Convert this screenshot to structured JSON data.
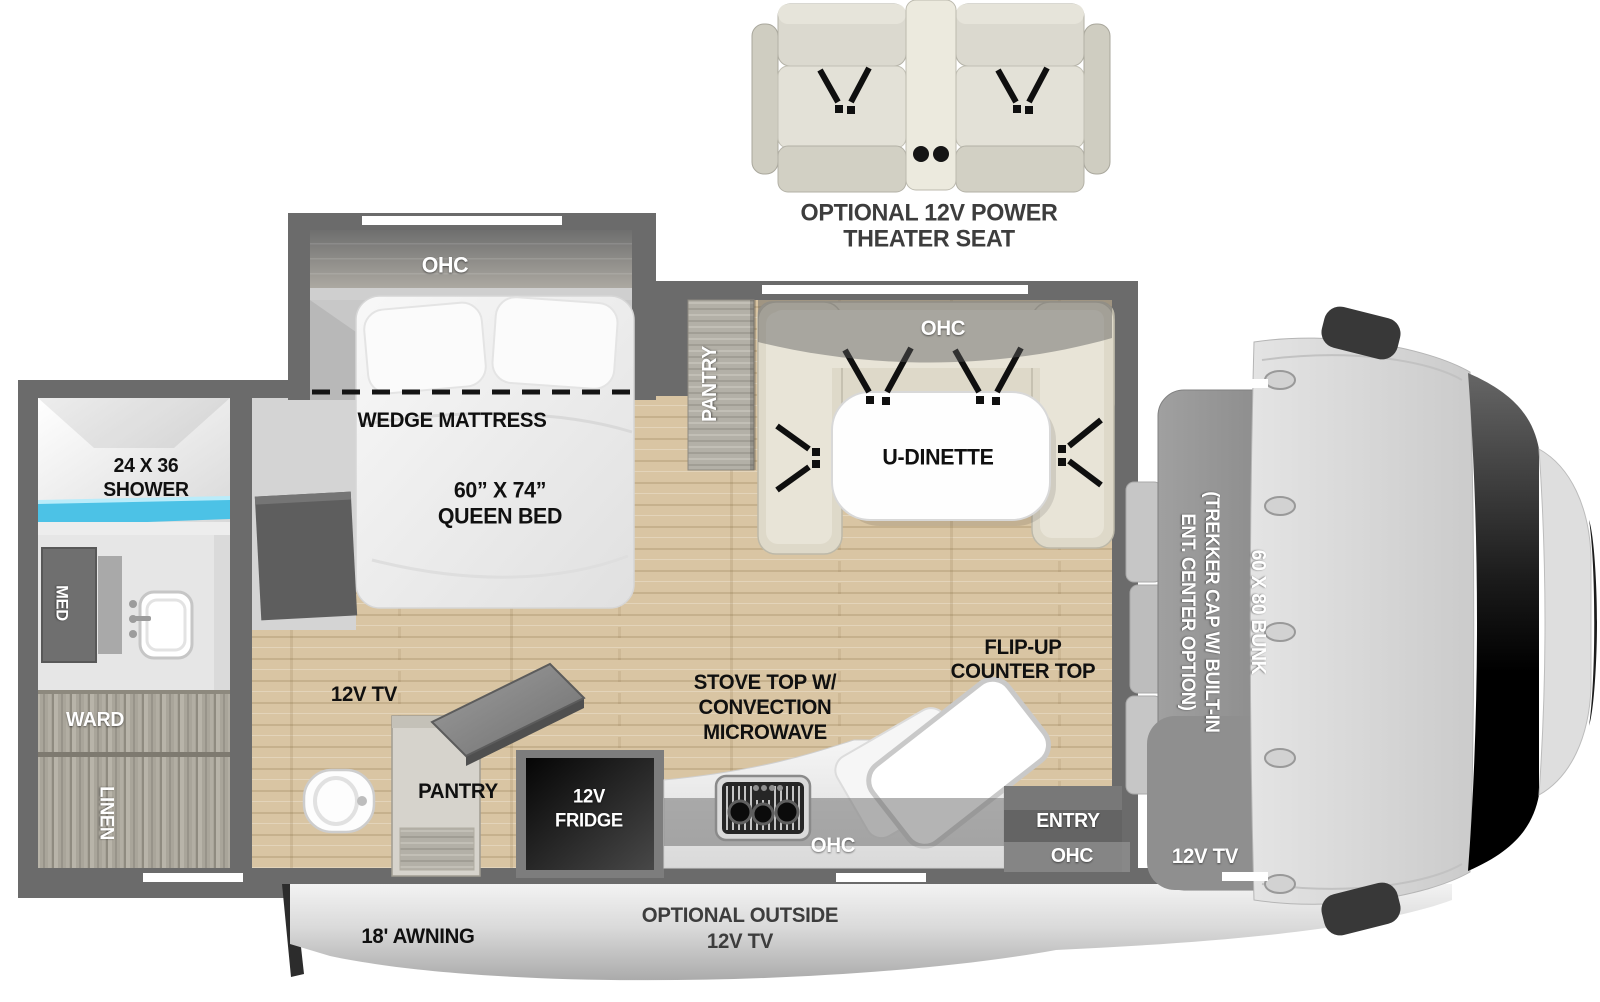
{
  "theater_seat": {
    "label_line1": "OPTIONAL 12V POWER",
    "label_line2": "THEATER SEAT"
  },
  "bedroom": {
    "ohc": "OHC",
    "wedge_mattress": "WEDGE MATTRESS",
    "bed_line1": "60” X 74”",
    "bed_line2": "QUEEN BED",
    "tv": "12V TV"
  },
  "bathroom": {
    "shower_line1": "24 X 36",
    "shower_line2": "SHOWER",
    "med": "MED",
    "ward": "WARD",
    "linen": "LINEN"
  },
  "dinette": {
    "pantry": "PANTRY",
    "ohc": "OHC",
    "table": "U-DINETTE"
  },
  "kitchen": {
    "pantry": "PANTRY",
    "fridge_line1": "12V",
    "fridge_line2": "FRIDGE",
    "stove_line1": "STOVE TOP W/",
    "stove_line2": "CONVECTION",
    "stove_line3": "MICROWAVE",
    "flip_line1": "FLIP-UP",
    "flip_line2": "COUNTER TOP",
    "ohc": "OHC"
  },
  "entry": {
    "label": "ENTRY",
    "ohc": "OHC"
  },
  "cab": {
    "trekker_line1": "(TREKKER CAP W/ BUILT-IN",
    "trekker_line2": "ENT. CENTER OPTION)",
    "bunk": "60 X 80 BUNK",
    "tv": "12V TV"
  },
  "exterior": {
    "awning": "18' AWNING",
    "outside_tv_line1": "OPTIONAL OUTSIDE",
    "outside_tv_line2": "12V TV"
  },
  "colors": {
    "wall": "#6b6b6b",
    "wood_floor": "#d7c3a2",
    "carpet": "#d4d4d4",
    "shower_water": "#4cc2e6",
    "dinette_upholstery": "#ded9c9",
    "label_black": "#101010",
    "label_white": "#ffffff"
  }
}
